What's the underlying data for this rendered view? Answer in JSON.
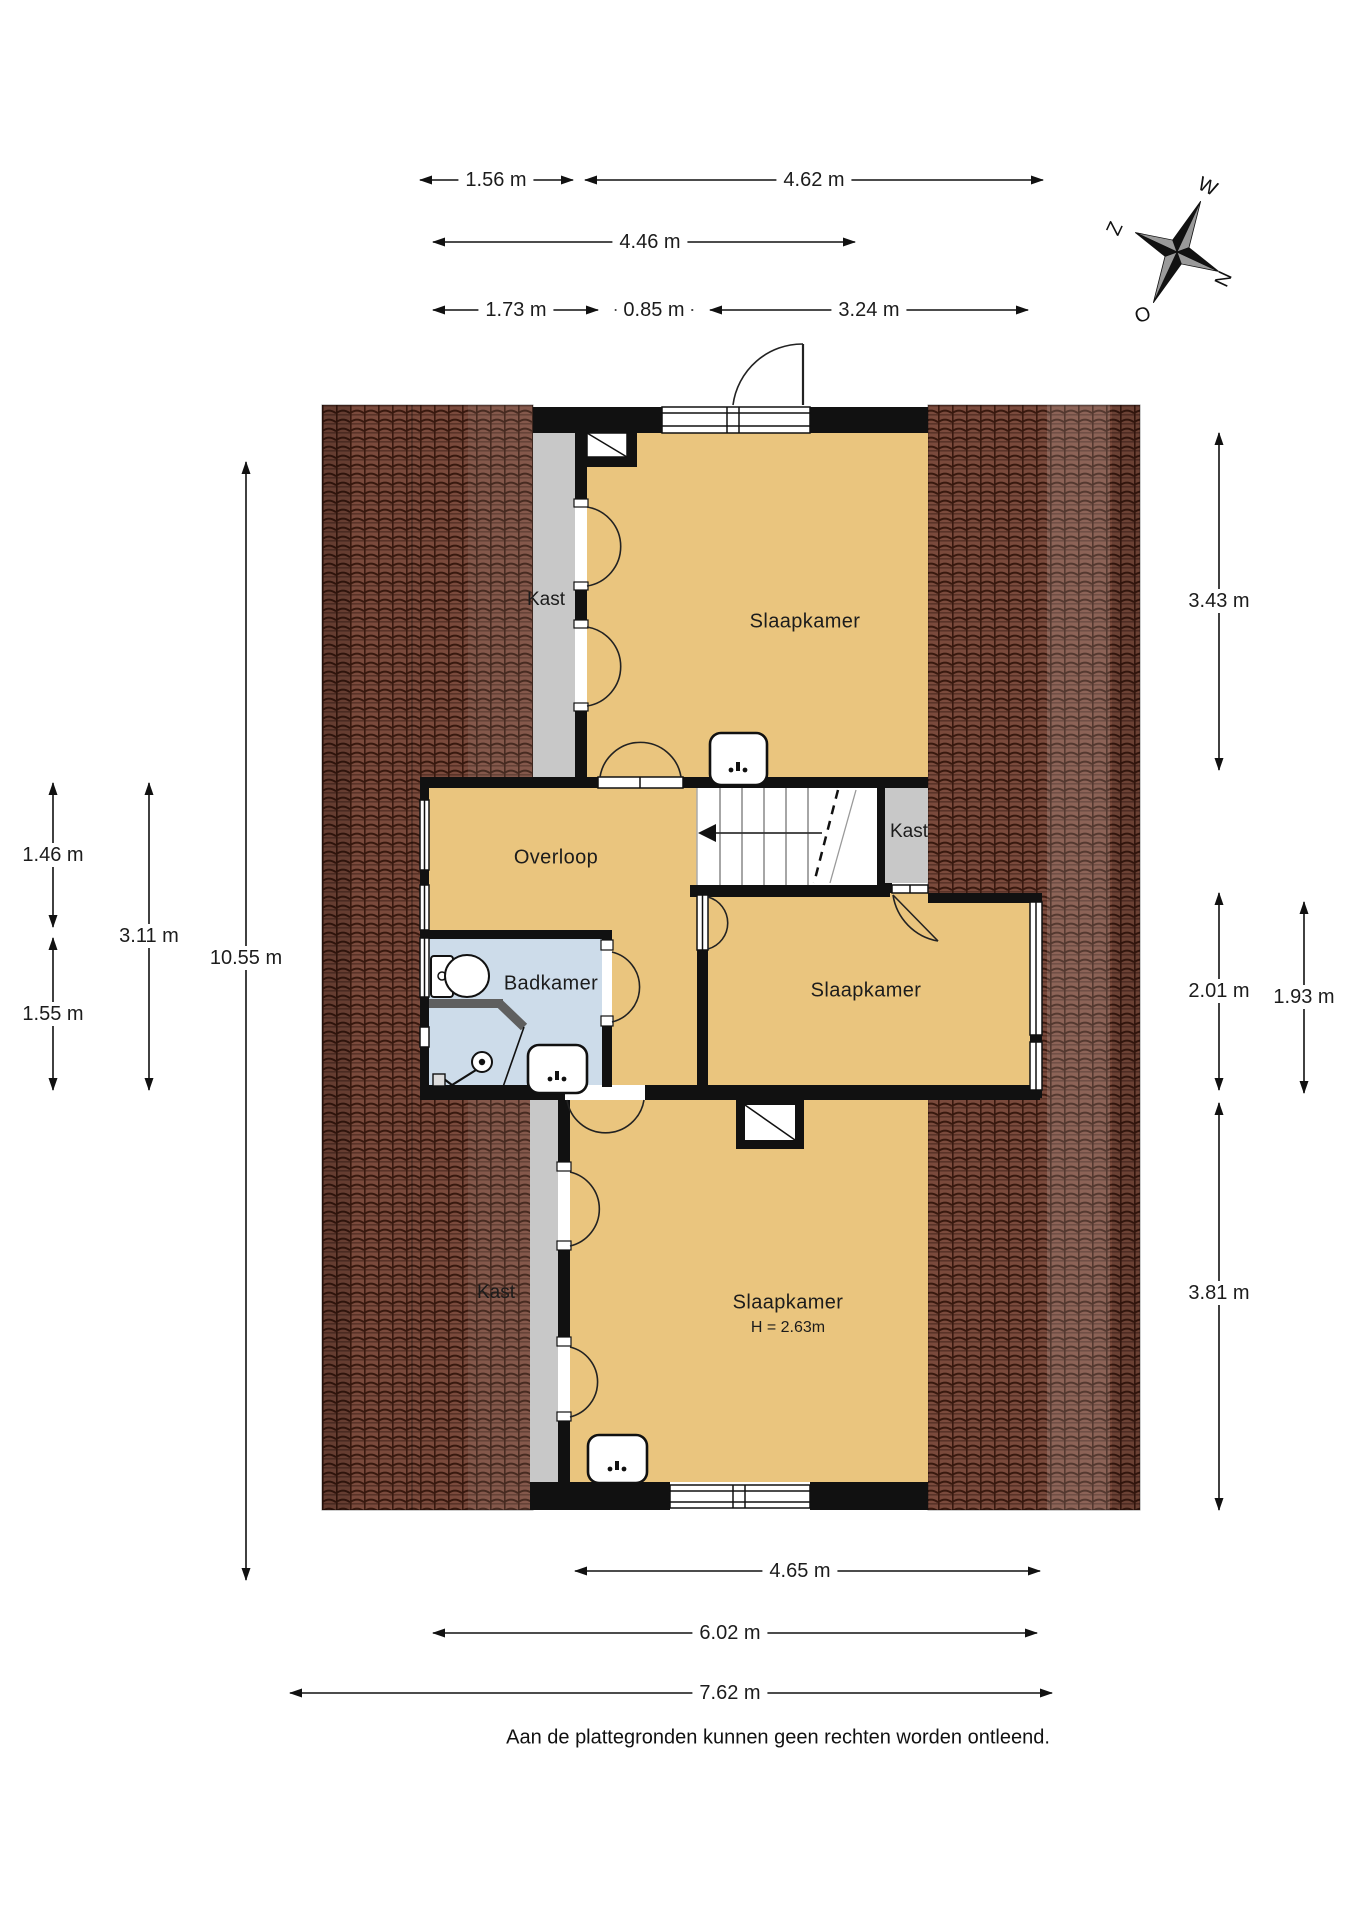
{
  "page": {
    "disclaimer": "Aan de plattegronden kunnen geen rechten worden ontleend."
  },
  "compass": {
    "north": "N",
    "east": "O",
    "south": "Z",
    "west": "W"
  },
  "rooms": {
    "bedroom_top": {
      "label": "Slaapkamer"
    },
    "closet_top": {
      "label": "Kast"
    },
    "landing": {
      "label": "Overloop"
    },
    "closet_mid": {
      "label": "Kast"
    },
    "bathroom": {
      "label": "Badkamer"
    },
    "bedroom_mid": {
      "label": "Slaapkamer"
    },
    "closet_bottom": {
      "label": "Kast"
    },
    "bedroom_bottom": {
      "label": "Slaapkamer",
      "ceiling_height": "H = 2.63m"
    }
  },
  "fixtures": {
    "toilet": "toilet",
    "shower": "shower",
    "washbasin_bedroom_top": "washbasin",
    "washbasin_bathroom": "washbasin",
    "washbasin_bedroom_bottom": "washbasin",
    "stairs": "stairs-down"
  },
  "dimensions": {
    "w_156": "1.56 m",
    "w_462": "4.62 m",
    "w_446": "4.46 m",
    "w_173": "1.73 m",
    "w_085": "0.85 m",
    "w_324": "3.24 m",
    "h_146": "1.46 m",
    "h_155": "1.55 m",
    "h_311": "3.11 m",
    "h_1055": "10.55 m",
    "h_343": "3.43 m",
    "h_201": "2.01 m",
    "h_193": "1.93 m",
    "h_381": "3.81 m",
    "w_465": "4.65 m",
    "w_602": "6.02 m",
    "w_762": "7.62 m"
  },
  "colors": {
    "room_orange": "#eac57e",
    "bathroom_blue": "#cddcea",
    "roof_brown": "#7a4a3c",
    "knee_wall_gray": "#c8c8c8",
    "wall_black": "#111111"
  }
}
